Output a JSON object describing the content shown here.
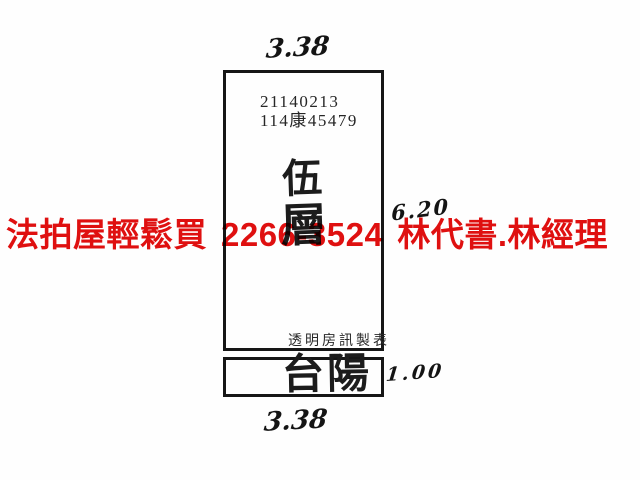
{
  "plan": {
    "case_no": "21140213",
    "case_ref": "114康45479",
    "floor_char_top": "伍",
    "floor_char_bottom": "層",
    "maker": "透明房訊製表",
    "balcony": "台陽",
    "dims": {
      "top": "3.38",
      "bottom": "3.38",
      "right_main": "6.20",
      "right_balcony": "1.00"
    }
  },
  "watermark": {
    "prefix": "法拍屋輕鬆買",
    "phone": "2266-3524",
    "agents": "林代書.林經理",
    "color": "#e01010"
  }
}
